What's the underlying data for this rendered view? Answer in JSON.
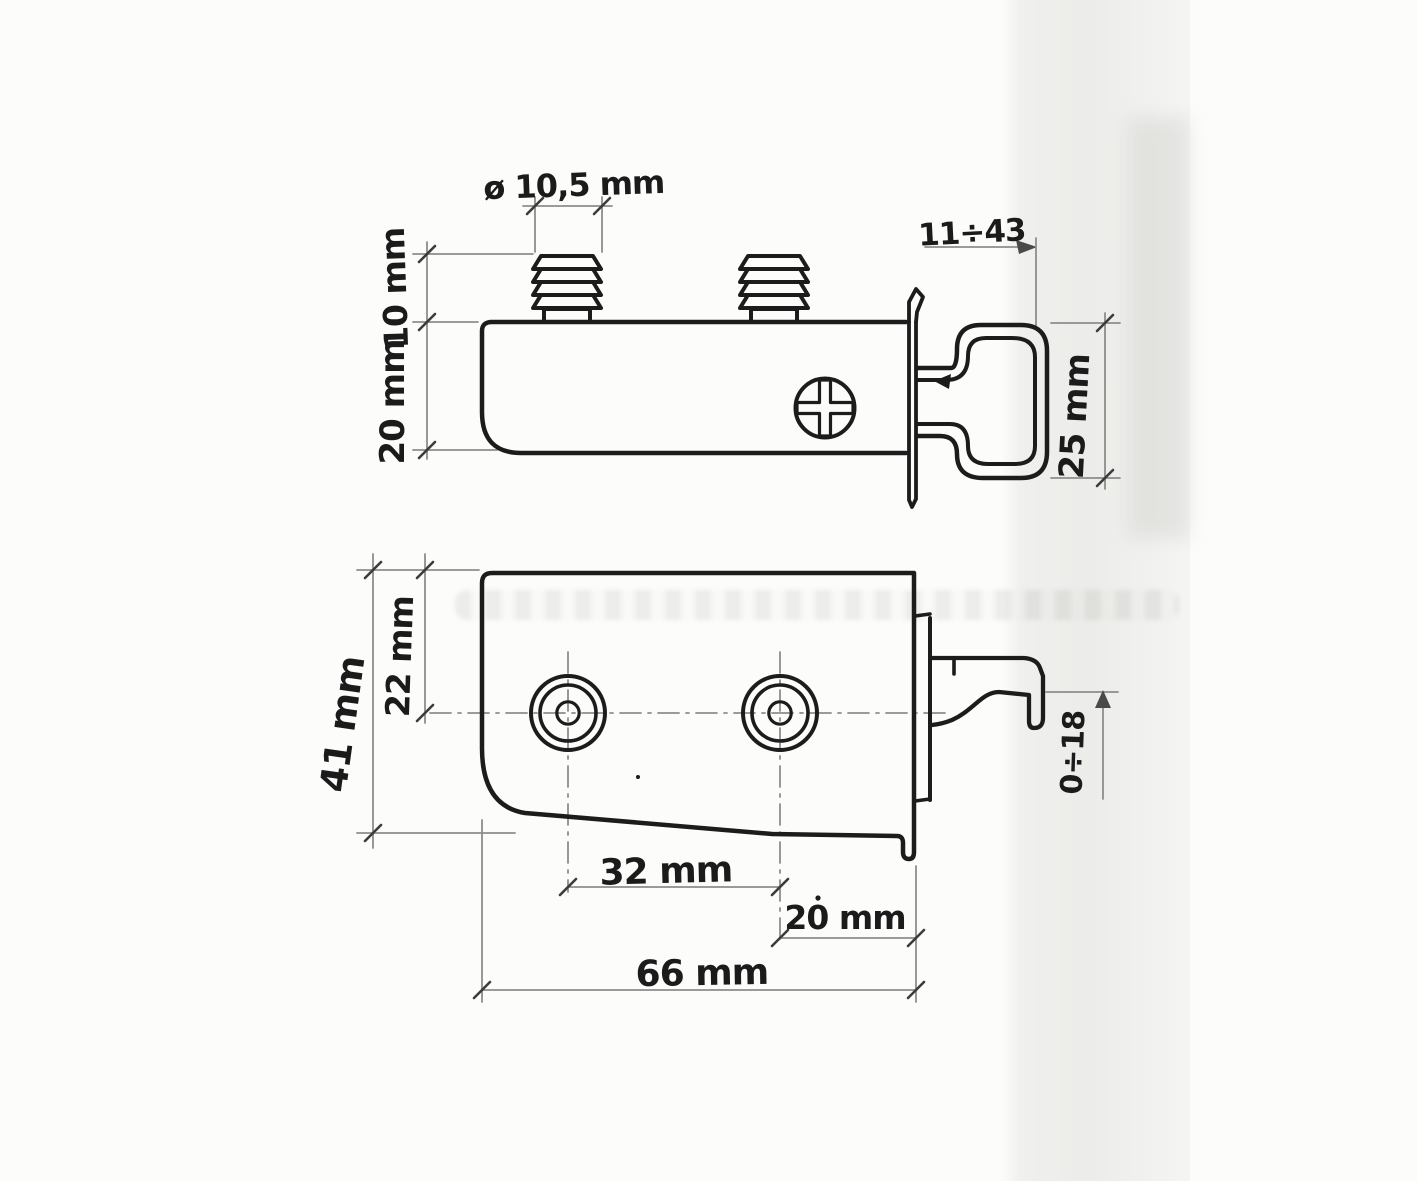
{
  "colors": {
    "ink": "#1c1c1c",
    "pencil": "#8d8d8d",
    "paper": "#fcfcfb"
  },
  "side_view": {
    "dims": {
      "stud_diameter": "ø 10,5 mm",
      "stud_height": "10 mm",
      "body_height": "20 mm",
      "mount_depth_range": "11÷43",
      "hook_height": "25 mm"
    }
  },
  "plan_view": {
    "dims": {
      "hole_center_offset": "22 mm",
      "plate_depth": "41 mm",
      "hole_spacing": "32 mm",
      "hook_edge_offset": "20 mm",
      "plate_length": "66 mm",
      "hook_travel_range": "0÷18"
    }
  }
}
